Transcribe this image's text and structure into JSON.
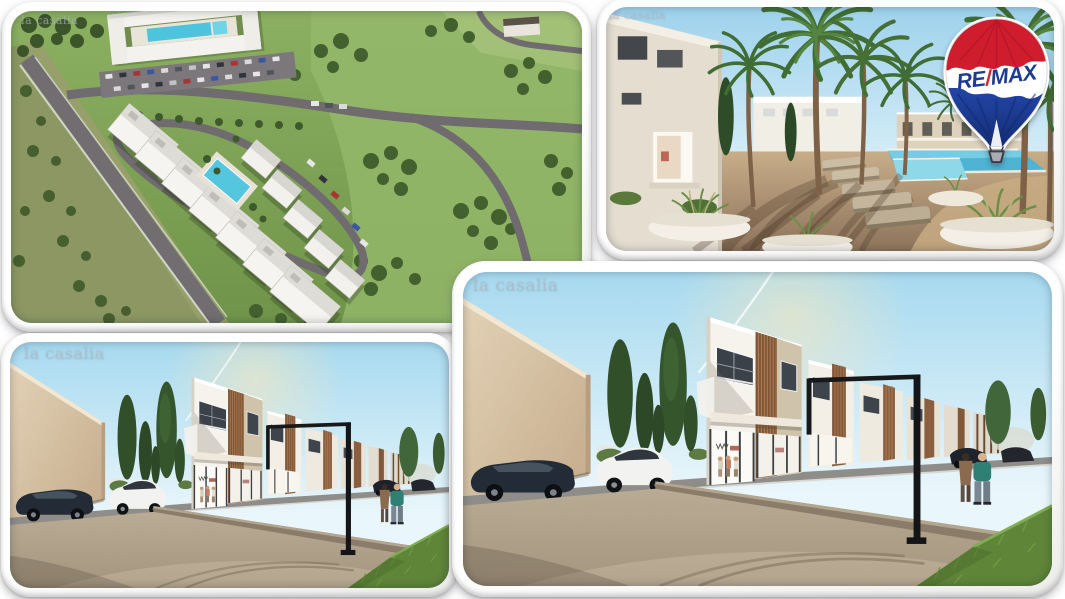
{
  "page": {
    "background": "#ffffff"
  },
  "brand": {
    "name": "RE/MAX",
    "balloon_icon": "remax-hot-air-balloon",
    "balloon_text": {
      "re": "RE",
      "slash": "/",
      "max": "MAX"
    },
    "colors": {
      "balloon_red": "#cf1d2e",
      "balloon_blue": "#1d3e97",
      "slash_red": "#d2232e",
      "text_blue": "#1d3b92",
      "basket_gray": "#a9adb2"
    }
  },
  "photos": {
    "aerial": {
      "alt": "aerial rendering of residential development site",
      "watermark": "la casalia"
    },
    "courtyard": {
      "alt": "courtyard with palm trees and pool rendering",
      "watermark": "la casalia"
    },
    "street_small": {
      "alt": "street elevation rendering of townhouses",
      "watermark": "la casalia"
    },
    "street_large": {
      "alt": "street elevation rendering of townhouses (large)",
      "watermark": "la casalia"
    }
  },
  "palette": {
    "sky": "#bfe3f3",
    "lawn_green": "#86a95c",
    "road_gray": "#6f6b6f",
    "gravel_tan": "#b2a48c",
    "wall_beige": "#d9c6ab",
    "wood_brown": "#8a5f3f",
    "pool_blue": "#4fb6d6"
  }
}
